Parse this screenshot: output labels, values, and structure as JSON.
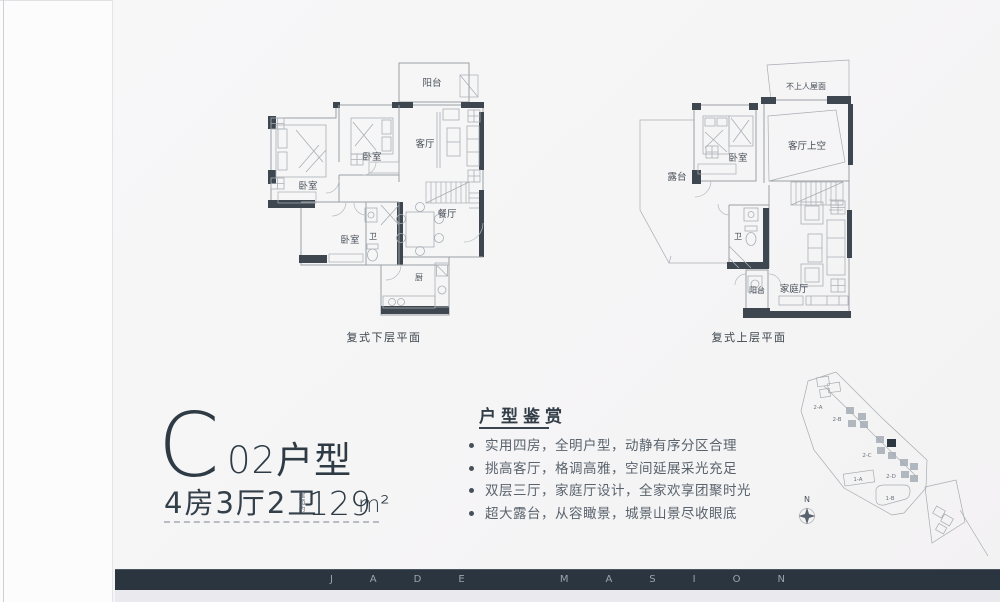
{
  "unit": {
    "letter": "C",
    "number": "02",
    "type_suffix": "户型",
    "layout": "4房3厅2卫",
    "area_prefix_chars": [
      "建",
      "面",
      "约"
    ],
    "area_value": "129",
    "area_unit": "m²"
  },
  "appreciation": {
    "title": "户型鉴赏",
    "bullets": [
      "实用四房，全明户型，动静有序分区合理",
      "挑高客厅，格调高雅，空间延展采光充足",
      "双层三厅，家庭厅设计，全家欢享团聚时光",
      "超大露台，从容瞰景，城景山景尽收眼底"
    ]
  },
  "plan_lower": {
    "caption": "复式下层平面",
    "rooms": {
      "balcony": "阳台",
      "living": "客厅",
      "bedroom": "卧室",
      "dining": "餐厅",
      "bath": "卫",
      "kitchen": "厨"
    }
  },
  "plan_upper": {
    "caption": "复式上层平面",
    "rooms": {
      "roof": "不上人屋面",
      "void": "客厅上空",
      "terrace": "露台",
      "bedroom": "卧室",
      "bath": "卫",
      "balcony": "阳台",
      "family": "家庭厅"
    }
  },
  "sitemap": {
    "north_label": "N",
    "block_labels": [
      "2-A",
      "2-B",
      "2-C",
      "2-D",
      "1-A",
      "1-B"
    ]
  },
  "footer": {
    "brand": "JADE MASION"
  },
  "colors": {
    "accent_dark": "#2e3b45",
    "wall_dark": "#3e474f",
    "footer_bar": "#2b3540",
    "text_gray": "#59636d"
  }
}
